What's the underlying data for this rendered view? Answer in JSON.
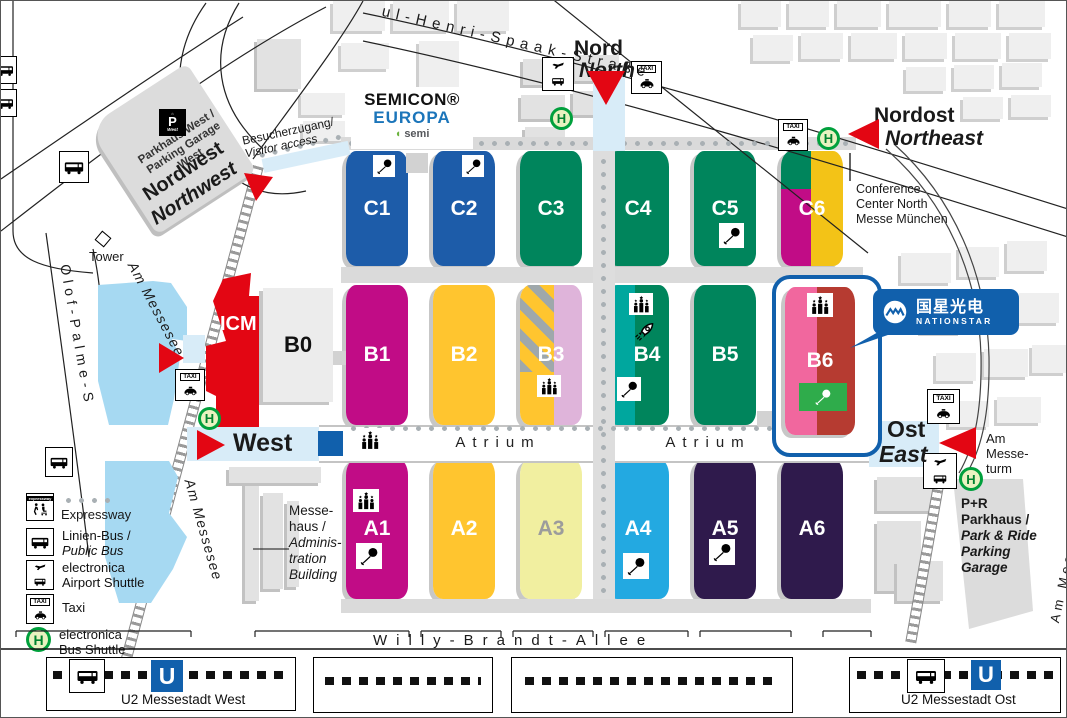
{
  "logo": {
    "line1": "SEMICON®",
    "line2": "EUROPA",
    "semi": "semi"
  },
  "entrances": {
    "north_de": "Nord",
    "north_en": "North",
    "northeast_de": "Nordost",
    "northeast_en": "Northeast",
    "northwest_de": "Nordwest",
    "northwest_en": "Northwest",
    "west": "West",
    "east_de": "Ost",
    "east_en": "East"
  },
  "halls": {
    "C1": {
      "label": "C1",
      "color": "#1D5CA9"
    },
    "C2": {
      "label": "C2",
      "color": "#1D5CA9"
    },
    "C3": {
      "label": "C3",
      "color": "#00855C"
    },
    "C4": {
      "label": "C4",
      "color": "#00855C"
    },
    "C5": {
      "label": "C5",
      "color": "#00855C"
    },
    "C6": {
      "label": "C6",
      "left_top": "#00855C",
      "left_bottom": "#C10C86",
      "right": "#F3C317"
    },
    "B1": {
      "label": "B1",
      "color": "#C10C86"
    },
    "B2": {
      "label": "B2",
      "color": "#FFC52F"
    },
    "B3": {
      "label": "B3",
      "left": "#FFC52F",
      "right": "#DFB4DA",
      "stripe": "#9FA8AB"
    },
    "B4": {
      "label": "B4",
      "left": "#00A79E",
      "right": "#00855C"
    },
    "B5": {
      "label": "B5",
      "color": "#00855C"
    },
    "B6": {
      "label": "B6",
      "left": "#F1679E",
      "right": "#B63B31",
      "highlight": "#1160AC",
      "stage": "#2FAC4B"
    },
    "A1": {
      "label": "A1",
      "color": "#C10C86"
    },
    "A2": {
      "label": "A2",
      "color": "#FFC52F"
    },
    "A3": {
      "label": "A3",
      "color": "#F1EFA0",
      "label_color": "#9C9C9C"
    },
    "A4": {
      "label": "A4",
      "color": "#23A9E1"
    },
    "A5": {
      "label": "A5",
      "color": "#2F1A4C"
    },
    "A6": {
      "label": "A6",
      "color": "#2F1A4C"
    },
    "B0": {
      "label": "B0"
    },
    "ICM": {
      "label": "ICM",
      "color": "#E30613"
    }
  },
  "atrium": {
    "left": "Atrium",
    "right": "Atrium"
  },
  "callout": {
    "cn": "国星光电",
    "en": "NATIONSTAR",
    "bg": "#1160AC"
  },
  "conference_center": {
    "l1": "Conference",
    "l2": "Center North",
    "l3": "Messe München"
  },
  "labels": {
    "visitor_access_de": "Besucherzugang/",
    "visitor_access_en": "Visitor access",
    "parkhaus_west_l1": "Parkhaus West /",
    "parkhaus_west_l2": "Parking Garage",
    "parkhaus_west_l3": "West",
    "tower": "Tower",
    "messehaus": [
      "Messe-",
      "haus /",
      "Adminis-",
      "tration",
      "Building"
    ],
    "am_messeturm": [
      "Am",
      "Messe-",
      "turm"
    ],
    "pr": [
      "P+R",
      "Parkhaus /",
      "Park & Ride",
      "Parking",
      "Garage"
    ]
  },
  "streets": {
    "spaak": "ul-Henri-Spaak-Straße",
    "olof": "Olof-Palme-S",
    "messesee_upper": "Am Messesee",
    "messesee_lower": "Am Messesee",
    "willy": "Willy-Brandt-Allee",
    "freigelaende": "Am Messefreigelände"
  },
  "legend": {
    "expressway": "Expressway",
    "bus_l1": "Linien-Bus /",
    "bus_l2": "Public Bus",
    "airport_l1": "electronica",
    "airport_l2": "Airport Shuttle",
    "taxi": "Taxi",
    "shuttle_l1": "electronica",
    "shuttle_l2": "Bus Shuttle"
  },
  "stations": {
    "west": "U2 Messestadt West",
    "east": "U2 Messestadt Ost"
  },
  "icon_labels": {
    "taxi": "TAXI",
    "expressway": "expressway",
    "h": "H",
    "u": "U",
    "p": "P",
    "p_west": "West"
  },
  "colors": {
    "accent_red": "#E30613",
    "ubahn_blue": "#1160AC",
    "lake": "#A6D9F2",
    "entrance_band": "#D8ECF8"
  }
}
